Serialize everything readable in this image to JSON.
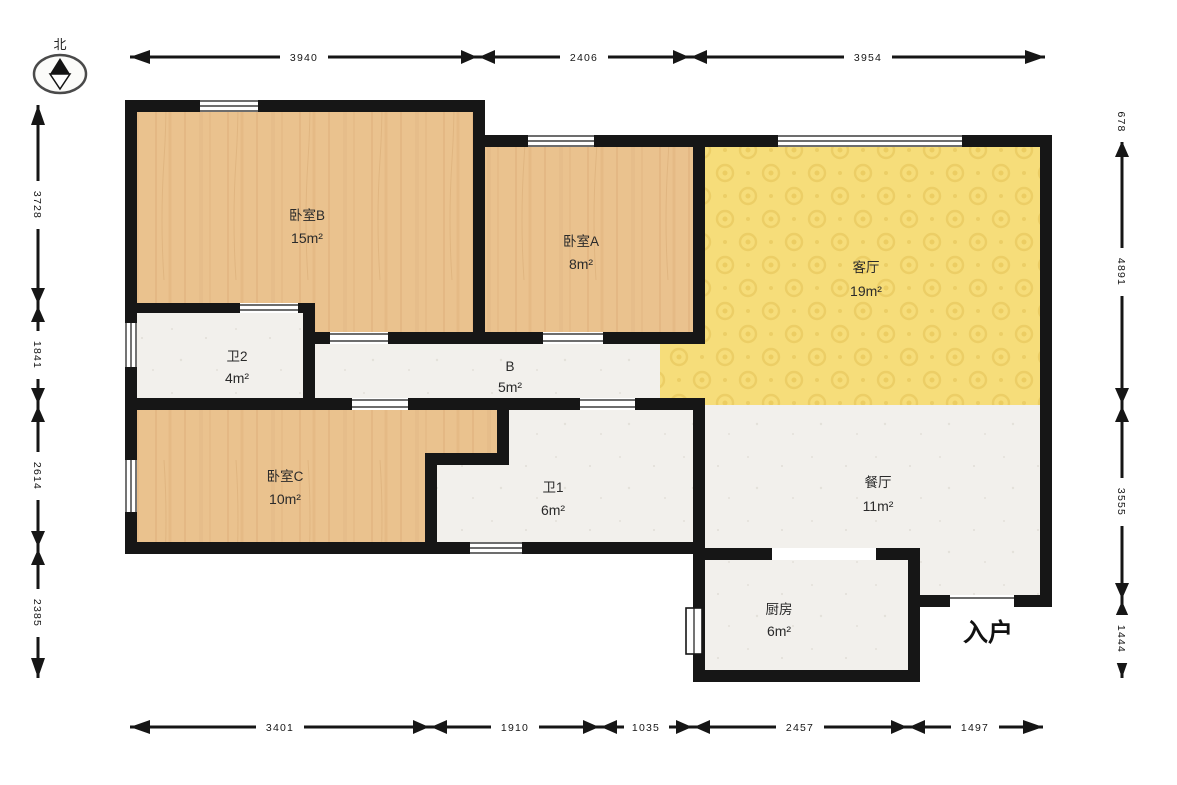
{
  "compass": {
    "label": "北"
  },
  "entry": {
    "label": "入户"
  },
  "rooms": {
    "bedroom_b": {
      "name": "卧室B",
      "area": "15m²"
    },
    "bedroom_a": {
      "name": "卧室A",
      "area": "8m²"
    },
    "living": {
      "name": "客厅",
      "area": "19m²"
    },
    "bath2": {
      "name": "卫2",
      "area": "4m²"
    },
    "hall": {
      "name": "B",
      "area": "5m²"
    },
    "bedroom_c": {
      "name": "卧室C",
      "area": "10m²"
    },
    "bath1": {
      "name": "卫1",
      "area": "6m²"
    },
    "dining": {
      "name": "餐厅",
      "area": "11m²"
    },
    "kitchen": {
      "name": "厨房",
      "area": "6m²"
    }
  },
  "dimensions": {
    "top": [
      "3940",
      "2406",
      "3954"
    ],
    "bottom": [
      "3401",
      "1910",
      "1035",
      "2457",
      "1497"
    ],
    "left": [
      "3728",
      "1841",
      "2614",
      "2385"
    ],
    "right": [
      "678",
      "4891",
      "3555",
      "1444"
    ]
  },
  "colors": {
    "wall": "#161616",
    "wood": "#eac28e",
    "wood_grain": "#d8a773",
    "living_yellow": "#f6dd7a",
    "living_pattern": "#ecce66",
    "light_floor": "#f2f0ec",
    "light_speck": "#e4e1da",
    "text": "#2a2a2a"
  }
}
